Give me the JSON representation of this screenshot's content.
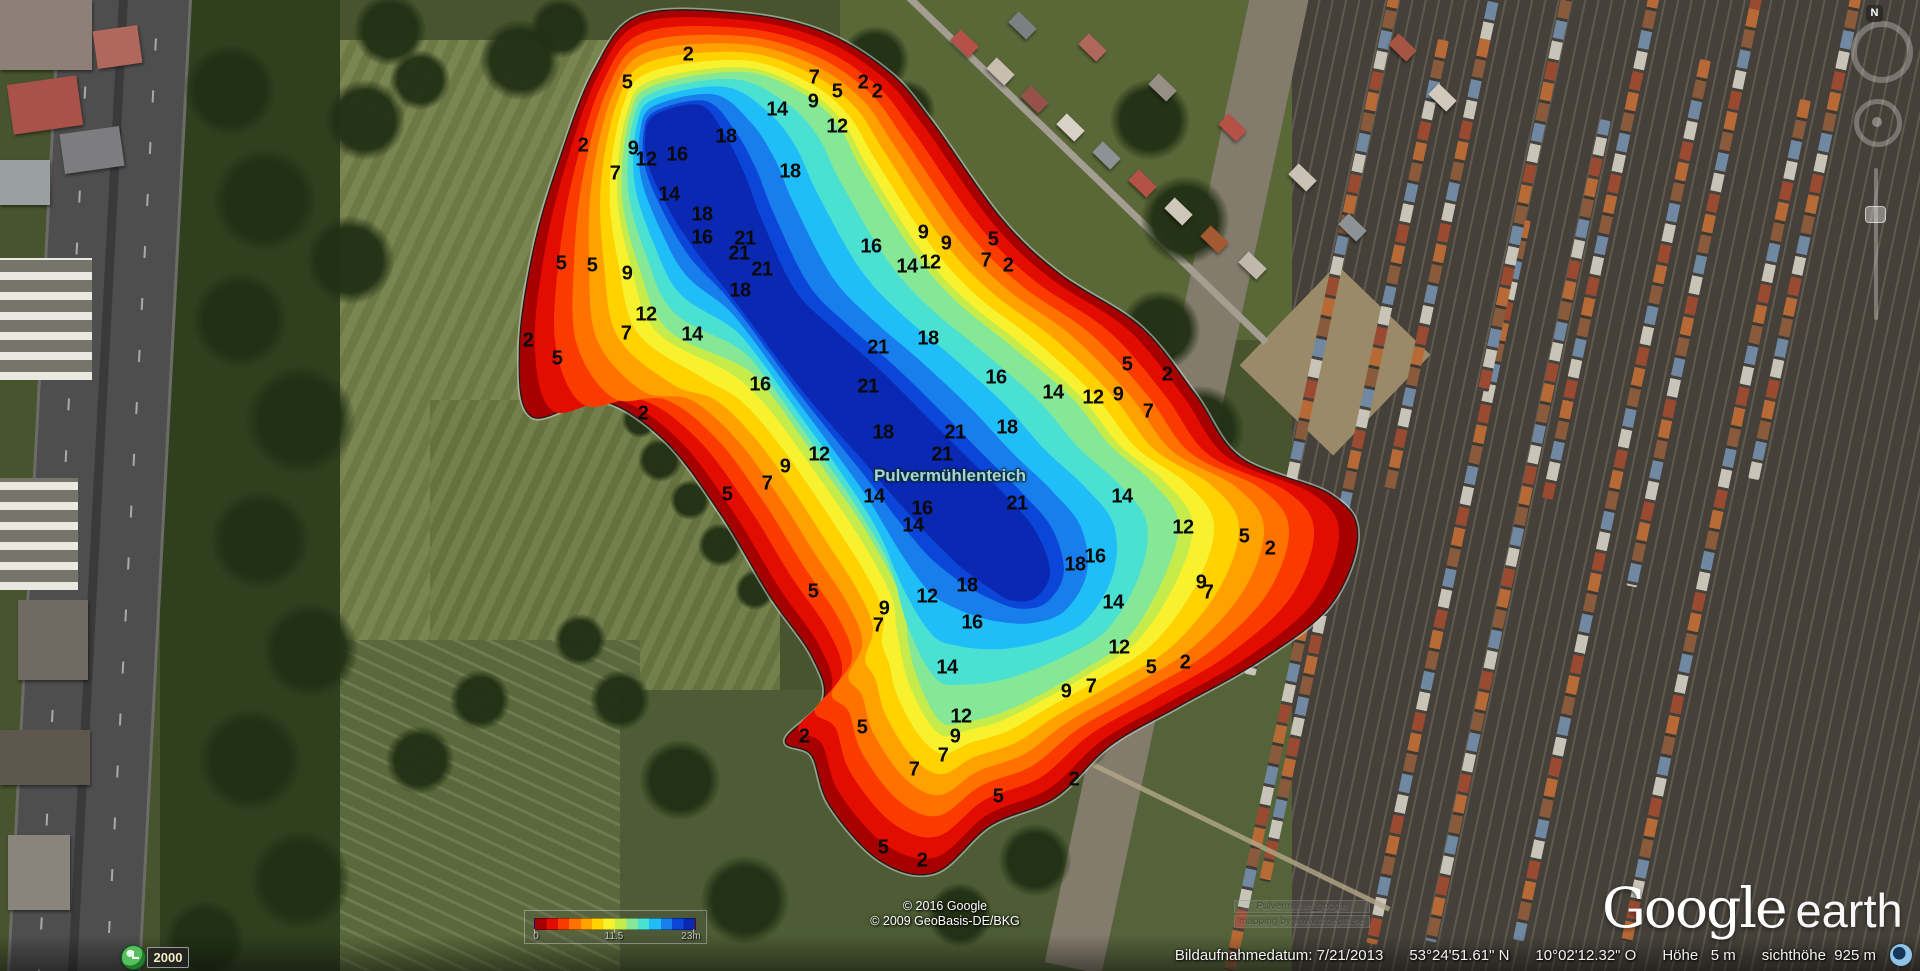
{
  "map_overlay": {
    "lake_label": "Pulvermühlenteich",
    "legend": {
      "min_label": "0",
      "mid_label": "11.5",
      "max_label": "23m",
      "palette": [
        "#a60000",
        "#e20c00",
        "#fb3a00",
        "#ff7200",
        "#ffa200",
        "#ffd200",
        "#f8f22e",
        "#c6ec4c",
        "#84e896",
        "#4ae0d2",
        "#20bef8",
        "#187eec",
        "#0b46d8",
        "#0a28b2"
      ]
    },
    "watermark": {
      "line1": "Pulvermühle_google",
      "line2": "mapping by www.drdepth.se"
    },
    "depth_labels": [
      {
        "x": 688,
        "y": 55,
        "v": "2"
      },
      {
        "x": 627,
        "y": 83,
        "v": "5"
      },
      {
        "x": 814,
        "y": 78,
        "v": "7"
      },
      {
        "x": 837,
        "y": 92,
        "v": "5"
      },
      {
        "x": 863,
        "y": 83,
        "v": "2"
      },
      {
        "x": 877,
        "y": 92,
        "v": "2"
      },
      {
        "x": 813,
        "y": 102,
        "v": "9"
      },
      {
        "x": 777,
        "y": 110,
        "v": "14"
      },
      {
        "x": 837,
        "y": 127,
        "v": "12"
      },
      {
        "x": 790,
        "y": 172,
        "v": "18"
      },
      {
        "x": 583,
        "y": 146,
        "v": "2"
      },
      {
        "x": 633,
        "y": 149,
        "v": "9"
      },
      {
        "x": 646,
        "y": 160,
        "v": "12"
      },
      {
        "x": 677,
        "y": 155,
        "v": "16"
      },
      {
        "x": 615,
        "y": 174,
        "v": "7"
      },
      {
        "x": 669,
        "y": 195,
        "v": "14"
      },
      {
        "x": 726,
        "y": 137,
        "v": "18"
      },
      {
        "x": 702,
        "y": 215,
        "v": "18"
      },
      {
        "x": 702,
        "y": 238,
        "v": "16"
      },
      {
        "x": 745,
        "y": 239,
        "v": "21"
      },
      {
        "x": 739,
        "y": 254,
        "v": "21"
      },
      {
        "x": 762,
        "y": 270,
        "v": "21"
      },
      {
        "x": 740,
        "y": 291,
        "v": "18"
      },
      {
        "x": 561,
        "y": 264,
        "v": "5"
      },
      {
        "x": 592,
        "y": 266,
        "v": "5"
      },
      {
        "x": 627,
        "y": 274,
        "v": "9"
      },
      {
        "x": 646,
        "y": 315,
        "v": "12"
      },
      {
        "x": 626,
        "y": 334,
        "v": "7"
      },
      {
        "x": 692,
        "y": 335,
        "v": "14"
      },
      {
        "x": 528,
        "y": 341,
        "v": "2"
      },
      {
        "x": 557,
        "y": 359,
        "v": "5"
      },
      {
        "x": 760,
        "y": 385,
        "v": "16"
      },
      {
        "x": 643,
        "y": 414,
        "v": "2"
      },
      {
        "x": 923,
        "y": 233,
        "v": "9"
      },
      {
        "x": 946,
        "y": 244,
        "v": "9"
      },
      {
        "x": 871,
        "y": 247,
        "v": "16"
      },
      {
        "x": 993,
        "y": 240,
        "v": "5"
      },
      {
        "x": 986,
        "y": 261,
        "v": "7"
      },
      {
        "x": 1008,
        "y": 266,
        "v": "2"
      },
      {
        "x": 907,
        "y": 267,
        "v": "14"
      },
      {
        "x": 930,
        "y": 263,
        "v": "12"
      },
      {
        "x": 928,
        "y": 339,
        "v": "18"
      },
      {
        "x": 878,
        "y": 348,
        "v": "21"
      },
      {
        "x": 868,
        "y": 387,
        "v": "21"
      },
      {
        "x": 996,
        "y": 378,
        "v": "16"
      },
      {
        "x": 1053,
        "y": 393,
        "v": "14"
      },
      {
        "x": 1093,
        "y": 398,
        "v": "12"
      },
      {
        "x": 1118,
        "y": 395,
        "v": "9"
      },
      {
        "x": 1127,
        "y": 365,
        "v": "5"
      },
      {
        "x": 1167,
        "y": 375,
        "v": "2"
      },
      {
        "x": 1148,
        "y": 412,
        "v": "7"
      },
      {
        "x": 883,
        "y": 433,
        "v": "18"
      },
      {
        "x": 955,
        "y": 433,
        "v": "21"
      },
      {
        "x": 1007,
        "y": 428,
        "v": "18"
      },
      {
        "x": 942,
        "y": 455,
        "v": "21"
      },
      {
        "x": 819,
        "y": 455,
        "v": "12"
      },
      {
        "x": 785,
        "y": 467,
        "v": "9"
      },
      {
        "x": 874,
        "y": 497,
        "v": "14"
      },
      {
        "x": 922,
        "y": 509,
        "v": "16"
      },
      {
        "x": 913,
        "y": 526,
        "v": "14"
      },
      {
        "x": 1017,
        "y": 504,
        "v": "21"
      },
      {
        "x": 1122,
        "y": 497,
        "v": "14"
      },
      {
        "x": 1183,
        "y": 528,
        "v": "12"
      },
      {
        "x": 1244,
        "y": 537,
        "v": "5"
      },
      {
        "x": 1270,
        "y": 549,
        "v": "2"
      },
      {
        "x": 1075,
        "y": 565,
        "v": "18"
      },
      {
        "x": 1095,
        "y": 557,
        "v": "16"
      },
      {
        "x": 767,
        "y": 484,
        "v": "7"
      },
      {
        "x": 727,
        "y": 495,
        "v": "5"
      },
      {
        "x": 813,
        "y": 592,
        "v": "5"
      },
      {
        "x": 884,
        "y": 609,
        "v": "9"
      },
      {
        "x": 878,
        "y": 626,
        "v": "7"
      },
      {
        "x": 927,
        "y": 597,
        "v": "12"
      },
      {
        "x": 967,
        "y": 586,
        "v": "18"
      },
      {
        "x": 972,
        "y": 623,
        "v": "16"
      },
      {
        "x": 947,
        "y": 668,
        "v": "14"
      },
      {
        "x": 961,
        "y": 717,
        "v": "12"
      },
      {
        "x": 955,
        "y": 737,
        "v": "9"
      },
      {
        "x": 943,
        "y": 756,
        "v": "7"
      },
      {
        "x": 914,
        "y": 770,
        "v": "7"
      },
      {
        "x": 862,
        "y": 728,
        "v": "5"
      },
      {
        "x": 804,
        "y": 737,
        "v": "2"
      },
      {
        "x": 1119,
        "y": 648,
        "v": "12"
      },
      {
        "x": 1066,
        "y": 692,
        "v": "9"
      },
      {
        "x": 1091,
        "y": 687,
        "v": "7"
      },
      {
        "x": 998,
        "y": 797,
        "v": "5"
      },
      {
        "x": 1074,
        "y": 780,
        "v": "2"
      },
      {
        "x": 883,
        "y": 848,
        "v": "5"
      },
      {
        "x": 922,
        "y": 861,
        "v": "2"
      },
      {
        "x": 1113,
        "y": 603,
        "v": "14"
      },
      {
        "x": 1201,
        "y": 583,
        "v": "9"
      },
      {
        "x": 1208,
        "y": 593,
        "v": "7"
      },
      {
        "x": 1151,
        "y": 668,
        "v": "5"
      },
      {
        "x": 1185,
        "y": 663,
        "v": "2"
      }
    ]
  },
  "attribution": {
    "line1": "© 2016 Google",
    "line2": "© 2009 GeoBasis-DE/BKG"
  },
  "logo": {
    "part1": "Google",
    "part2": "earth"
  },
  "status_bar": {
    "date_label": "Bildaufnahmedatum:",
    "date": "7/21/2013",
    "latitude": "53°24'51.61\" N",
    "longitude": "10°02'12.32\" O",
    "elevation_label": "Höhe",
    "elevation": "5 m",
    "eye_altitude_label": "sichthöhe",
    "eye_altitude": "925 m"
  },
  "time_control": {
    "year": "2000"
  },
  "navigation": {
    "north_label": "N"
  }
}
